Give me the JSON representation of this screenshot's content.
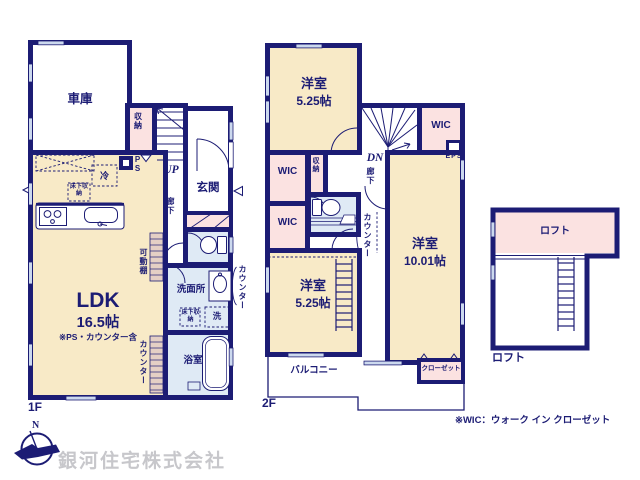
{
  "colors": {
    "wall": "#1c1c74",
    "room_tan": "#f8eac7",
    "room_pink": "#fbe2e1",
    "room_blue": "#dfeaf5",
    "window": "#ccd9ee",
    "watermark": "#c7c7cb"
  },
  "floor1": {
    "label": "1F",
    "garage": "車庫",
    "storage": "収納",
    "up": "UP",
    "entrance": "玄関",
    "hallway": "廊下",
    "fridge": "冷",
    "ps": "PS",
    "underfloor_storage": "床下収納",
    "ldk_name": "LDK",
    "ldk_size": "16.5帖",
    "ldk_note": "※PS・カウンター含",
    "movable_shelf": "可動棚",
    "counter": "カウンター",
    "washroom": "洗面所",
    "laundry": "洗",
    "bathroom": "浴室"
  },
  "floor2": {
    "label": "2F",
    "room_top_name": "洋室",
    "room_top_size": "5.25帖",
    "dn": "DN",
    "wic": "WIC",
    "eps": "EPS",
    "storage": "収納",
    "hallway": "廊下",
    "counter": "カウンター",
    "room_right_name": "洋室",
    "room_right_size": "10.01帖",
    "room_bottom_name": "洋室",
    "room_bottom_size": "5.25帖",
    "balcony": "バルコニー",
    "closet": "クローゼット"
  },
  "loft": {
    "room_label": "ロフト",
    "floor_label": "ロフト"
  },
  "legend": {
    "wic_note": "※WIC：ウォーク イン クローゼット"
  },
  "compass": {
    "north": "N"
  },
  "watermark": {
    "company": "銀河住宅株式会社"
  }
}
